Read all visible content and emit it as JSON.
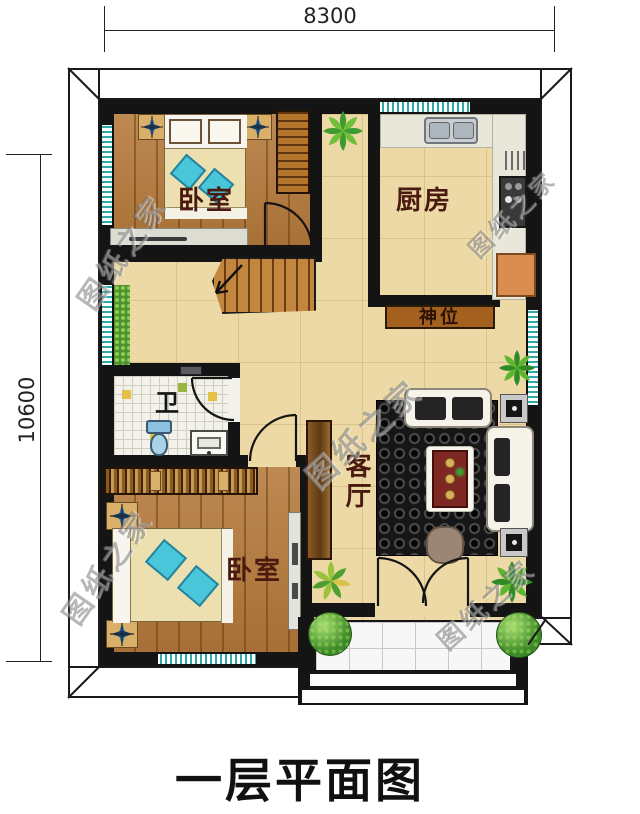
{
  "title": "一层平面图",
  "dimensions": {
    "width_label": "8300",
    "height_label": "10600"
  },
  "rooms": {
    "bedroom_top": "卧室",
    "kitchen": "厨房",
    "shrine": "神位",
    "bathroom": "卫",
    "living_room": "客厅",
    "bedroom_bottom": "卧室"
  },
  "watermark": {
    "text": "图纸之家"
  },
  "colors": {
    "wall": "#141414",
    "tile_floor": "#ecd9a5",
    "wood_floor": "#b5793a",
    "window_teal": "#2fa8a8",
    "room_label": "#4a1a10",
    "shrine_bg": "#a3601f",
    "rug": "#181818"
  }
}
